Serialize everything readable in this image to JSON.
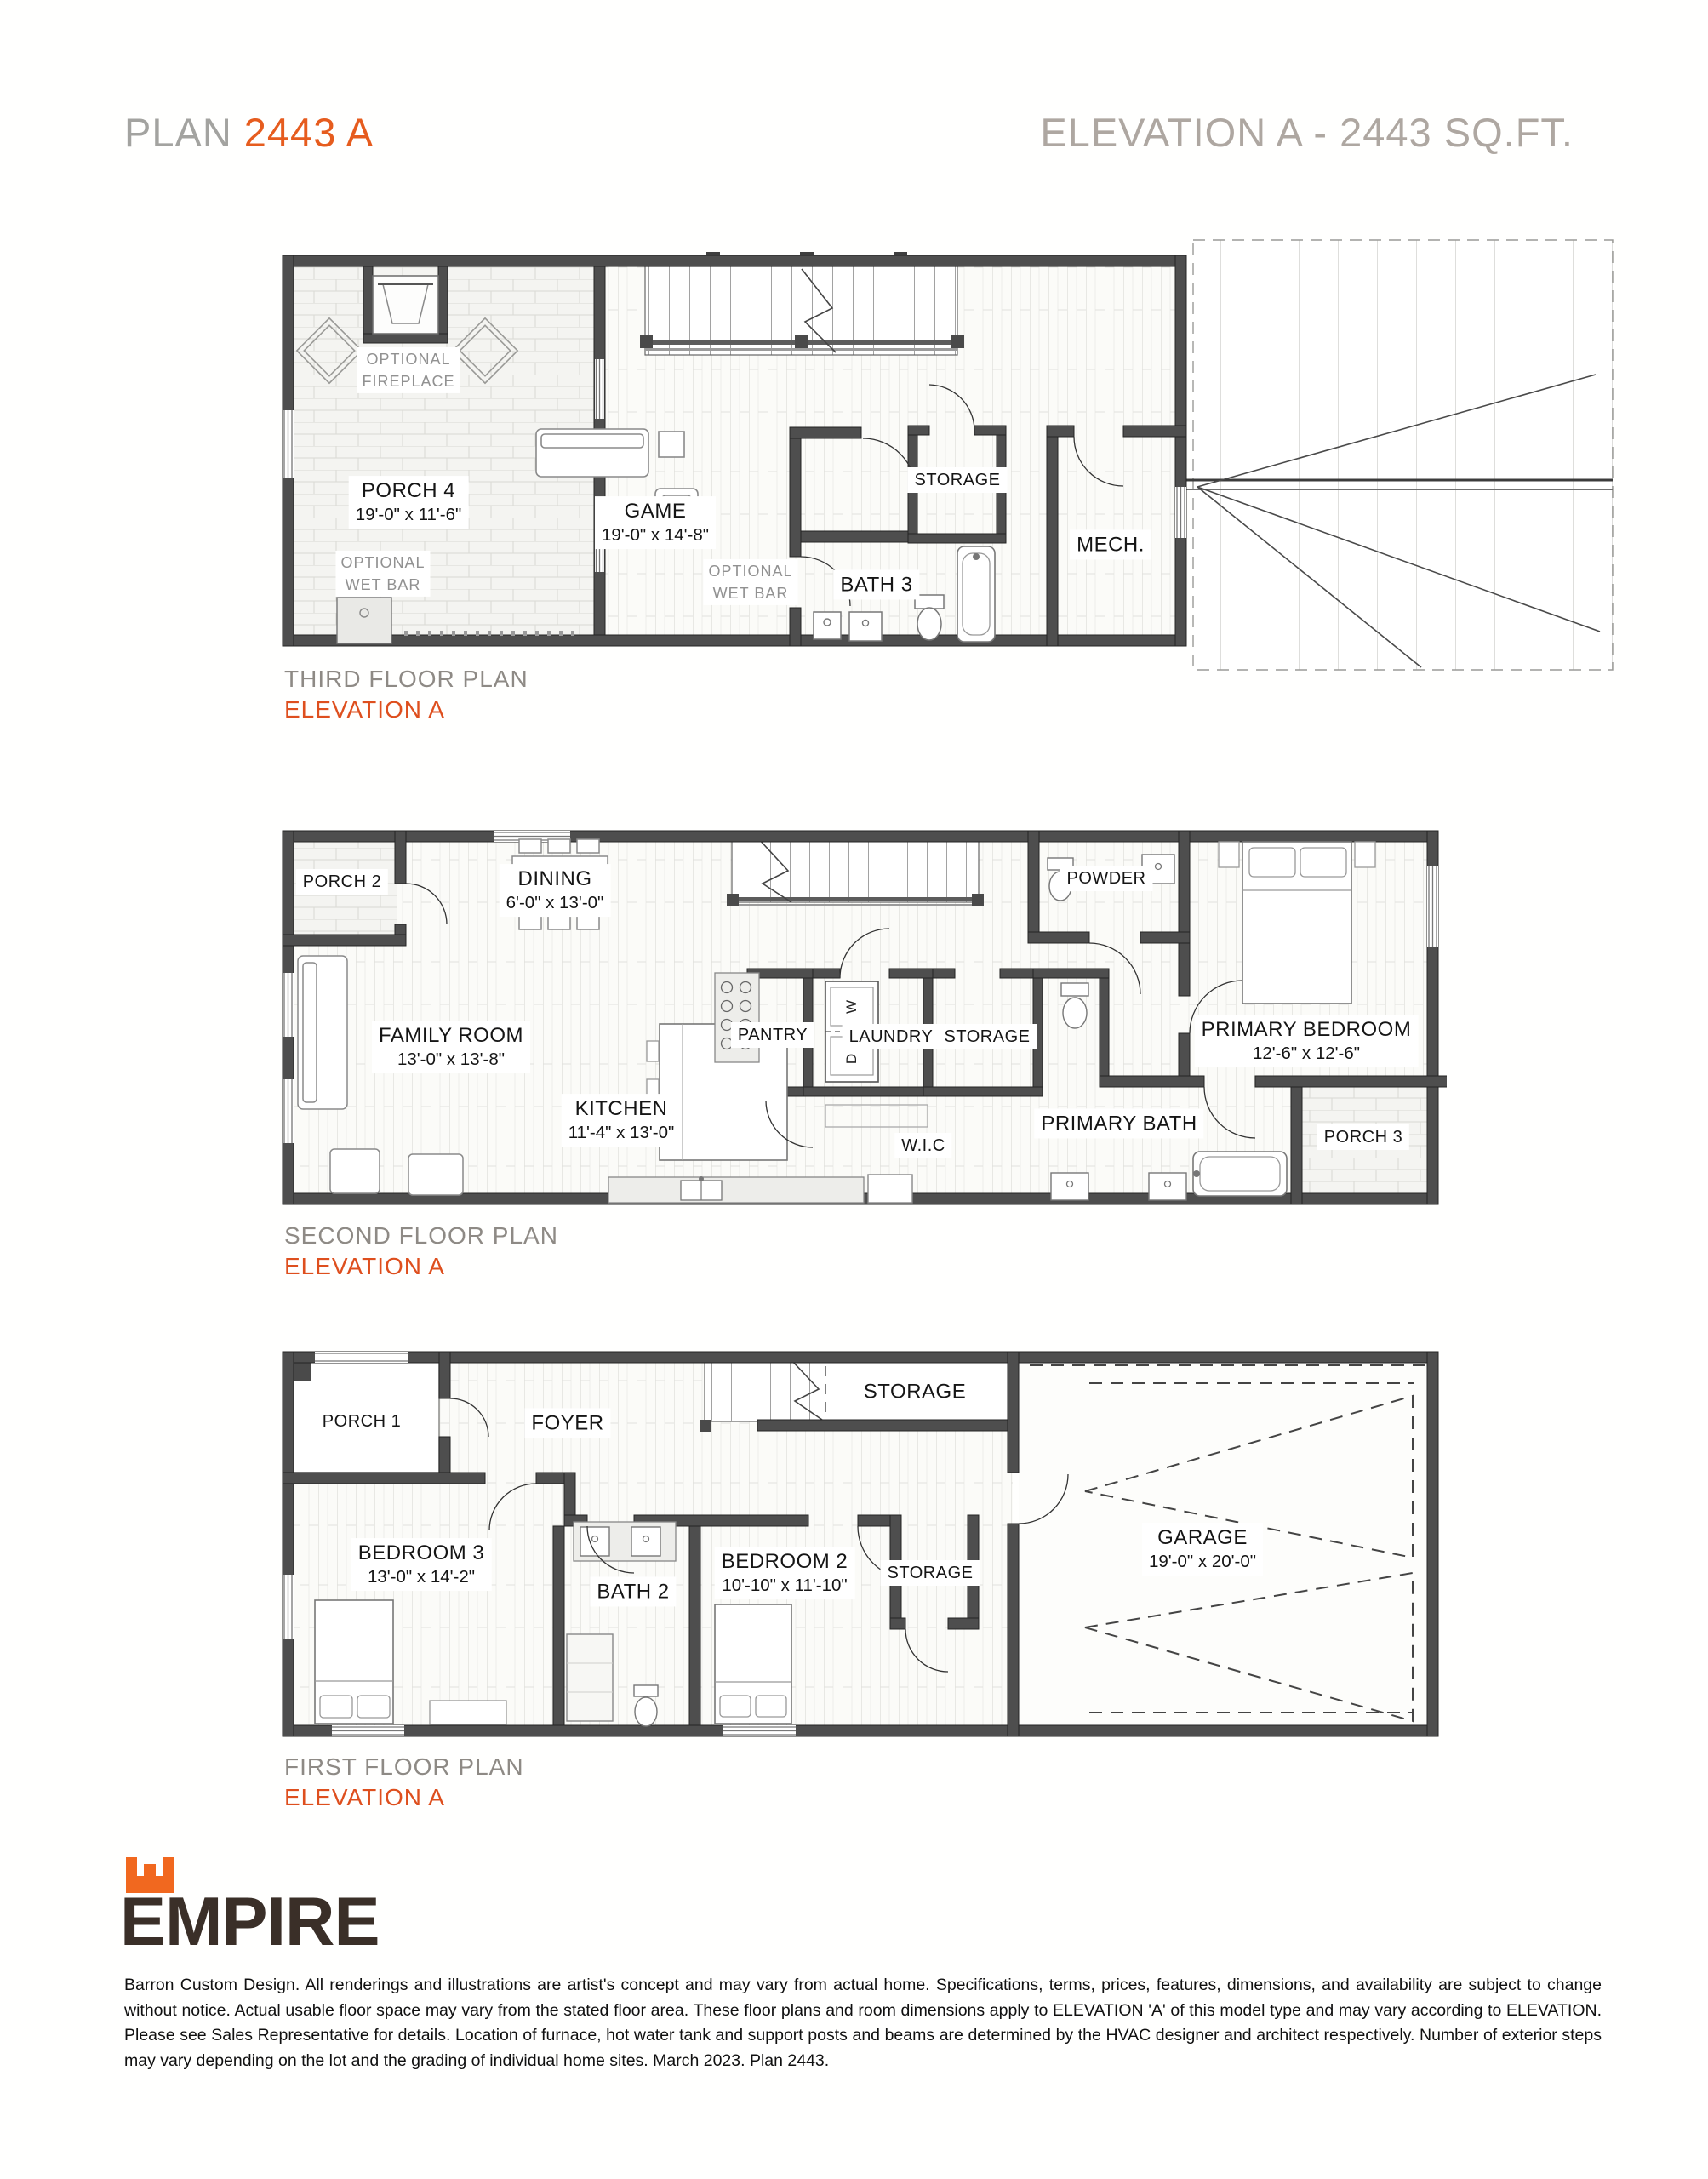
{
  "header": {
    "plan_prefix": "PLAN",
    "plan_number": "2443 A",
    "elevation_title": "ELEVATION A - 2443 SQ.FT."
  },
  "floors": {
    "third": {
      "caption": "THIRD FLOOR PLAN",
      "elevation": "ELEVATION A",
      "rooms": {
        "porch4": {
          "name": "PORCH 4",
          "dims": "19'-0\" x 11'-6\""
        },
        "game": {
          "name": "GAME",
          "dims": "19'-0\" x 14'-8\""
        },
        "storage": {
          "name": "STORAGE"
        },
        "mech": {
          "name": "MECH."
        },
        "bath3": {
          "name": "BATH 3"
        }
      },
      "notes": {
        "fireplace": [
          "OPTIONAL",
          "FIREPLACE"
        ],
        "wetbar_porch": [
          "OPTIONAL",
          "WET BAR"
        ],
        "wetbar_game": [
          "OPTIONAL",
          "WET BAR"
        ]
      }
    },
    "second": {
      "caption": "SECOND FLOOR PLAN",
      "elevation": "ELEVATION A",
      "rooms": {
        "porch2": {
          "name": "PORCH 2"
        },
        "dining": {
          "name": "DINING",
          "dims": "6'-0\" x 13'-0\""
        },
        "powder": {
          "name": "POWDER"
        },
        "primary_bedroom": {
          "name": "PRIMARY BEDROOM",
          "dims": "12'-6\" x 12'-6\""
        },
        "family_room": {
          "name": "FAMILY ROOM",
          "dims": "13'-0\" x 13'-8\""
        },
        "kitchen": {
          "name": "KITCHEN",
          "dims": "11'-4\" x 13'-0\""
        },
        "pantry": {
          "name": "PANTRY"
        },
        "laundry": {
          "name": "LAUNDRY"
        },
        "storage": {
          "name": "STORAGE"
        },
        "wic": {
          "name": "W.I.C"
        },
        "primary_bath": {
          "name": "PRIMARY BATH"
        },
        "porch3": {
          "name": "PORCH 3"
        },
        "washer": "W",
        "dryer": "D"
      }
    },
    "first": {
      "caption": "FIRST FLOOR PLAN",
      "elevation": "ELEVATION A",
      "rooms": {
        "porch1": {
          "name": "PORCH 1"
        },
        "foyer": {
          "name": "FOYER"
        },
        "storage_top": {
          "name": "STORAGE"
        },
        "bedroom3": {
          "name": "BEDROOM 3",
          "dims": "13'-0\" x 14'-2\""
        },
        "bath2": {
          "name": "BATH 2"
        },
        "bedroom2": {
          "name": "BEDROOM 2",
          "dims": "10'-10\" x 11'-10\""
        },
        "storage_mid": {
          "name": "STORAGE"
        },
        "garage": {
          "name": "GARAGE",
          "dims": "19'-0\" x 20'-0\""
        }
      }
    }
  },
  "footer": {
    "logo_text": "EMPIRE",
    "disclaimer": "Barron Custom Design. All renderings and illustrations are artist's concept and may vary from actual home. Specifications, terms, prices, features, dimensions, and availability are subject to change without notice. Actual usable floor space may vary from the stated floor area. These floor plans and room dimensions apply to ELEVATION 'A' of this model type and may vary according to ELEVATION. Please see Sales Representative for details. Location of furnace, hot water tank and support posts and beams are determined by the HVAC designer and architect respectively. Number of exterior steps may vary depending on the lot and the grading of individual home sites. March 2023. Plan 2443."
  }
}
